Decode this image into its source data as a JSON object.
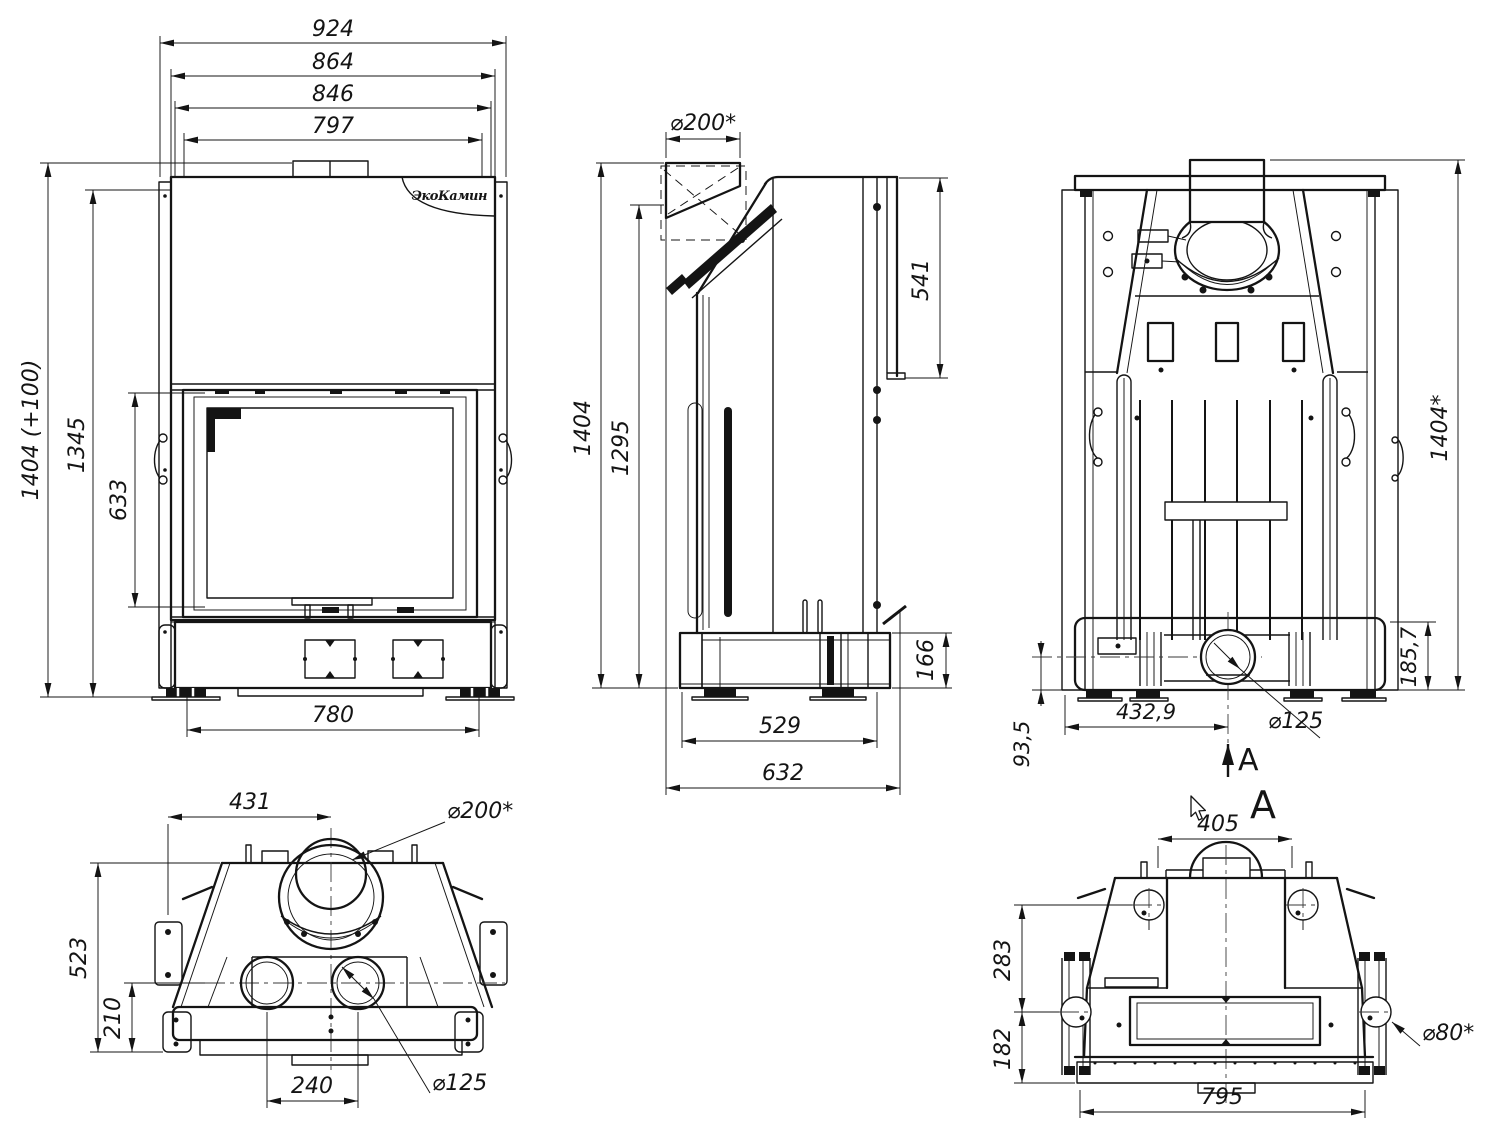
{
  "brand": {
    "logo": "ЭкоКамин"
  },
  "section_marker": {
    "arrow_label": "A",
    "view_label": "A"
  },
  "views": {
    "front": {
      "dims": {
        "overall_width": "924",
        "body_width": "864",
        "inner_width": "846",
        "door_width": "797",
        "overall_height": "1404 (+100)",
        "upper_height": "1345",
        "glass_height": "633",
        "base_width": "780"
      }
    },
    "side": {
      "dims": {
        "flue_diameter": "⌀200*",
        "upper_depth": "541",
        "overall_height": "1404",
        "flue_height": "1295",
        "rear_base_height": "166",
        "base_depth": "529",
        "overall_depth": "632"
      }
    },
    "back": {
      "dims": {
        "overall_height": "1404*",
        "base_height": "185,7",
        "outlet_offset": "432,9",
        "outlet_diameter": "⌀125",
        "outlet_height": "93,5"
      }
    },
    "top": {
      "dims": {
        "flue_offset": "431",
        "flue_diameter": "⌀200*",
        "overall_depth": "523",
        "front_depth": "210",
        "outlet_spacing": "240",
        "outlet_diameter": "⌀125"
      }
    },
    "section": {
      "dims": {
        "top_width": "405",
        "upper_height": "283",
        "lower_height": "182",
        "hole_diameter": "⌀80*",
        "base_width": "795"
      }
    }
  }
}
